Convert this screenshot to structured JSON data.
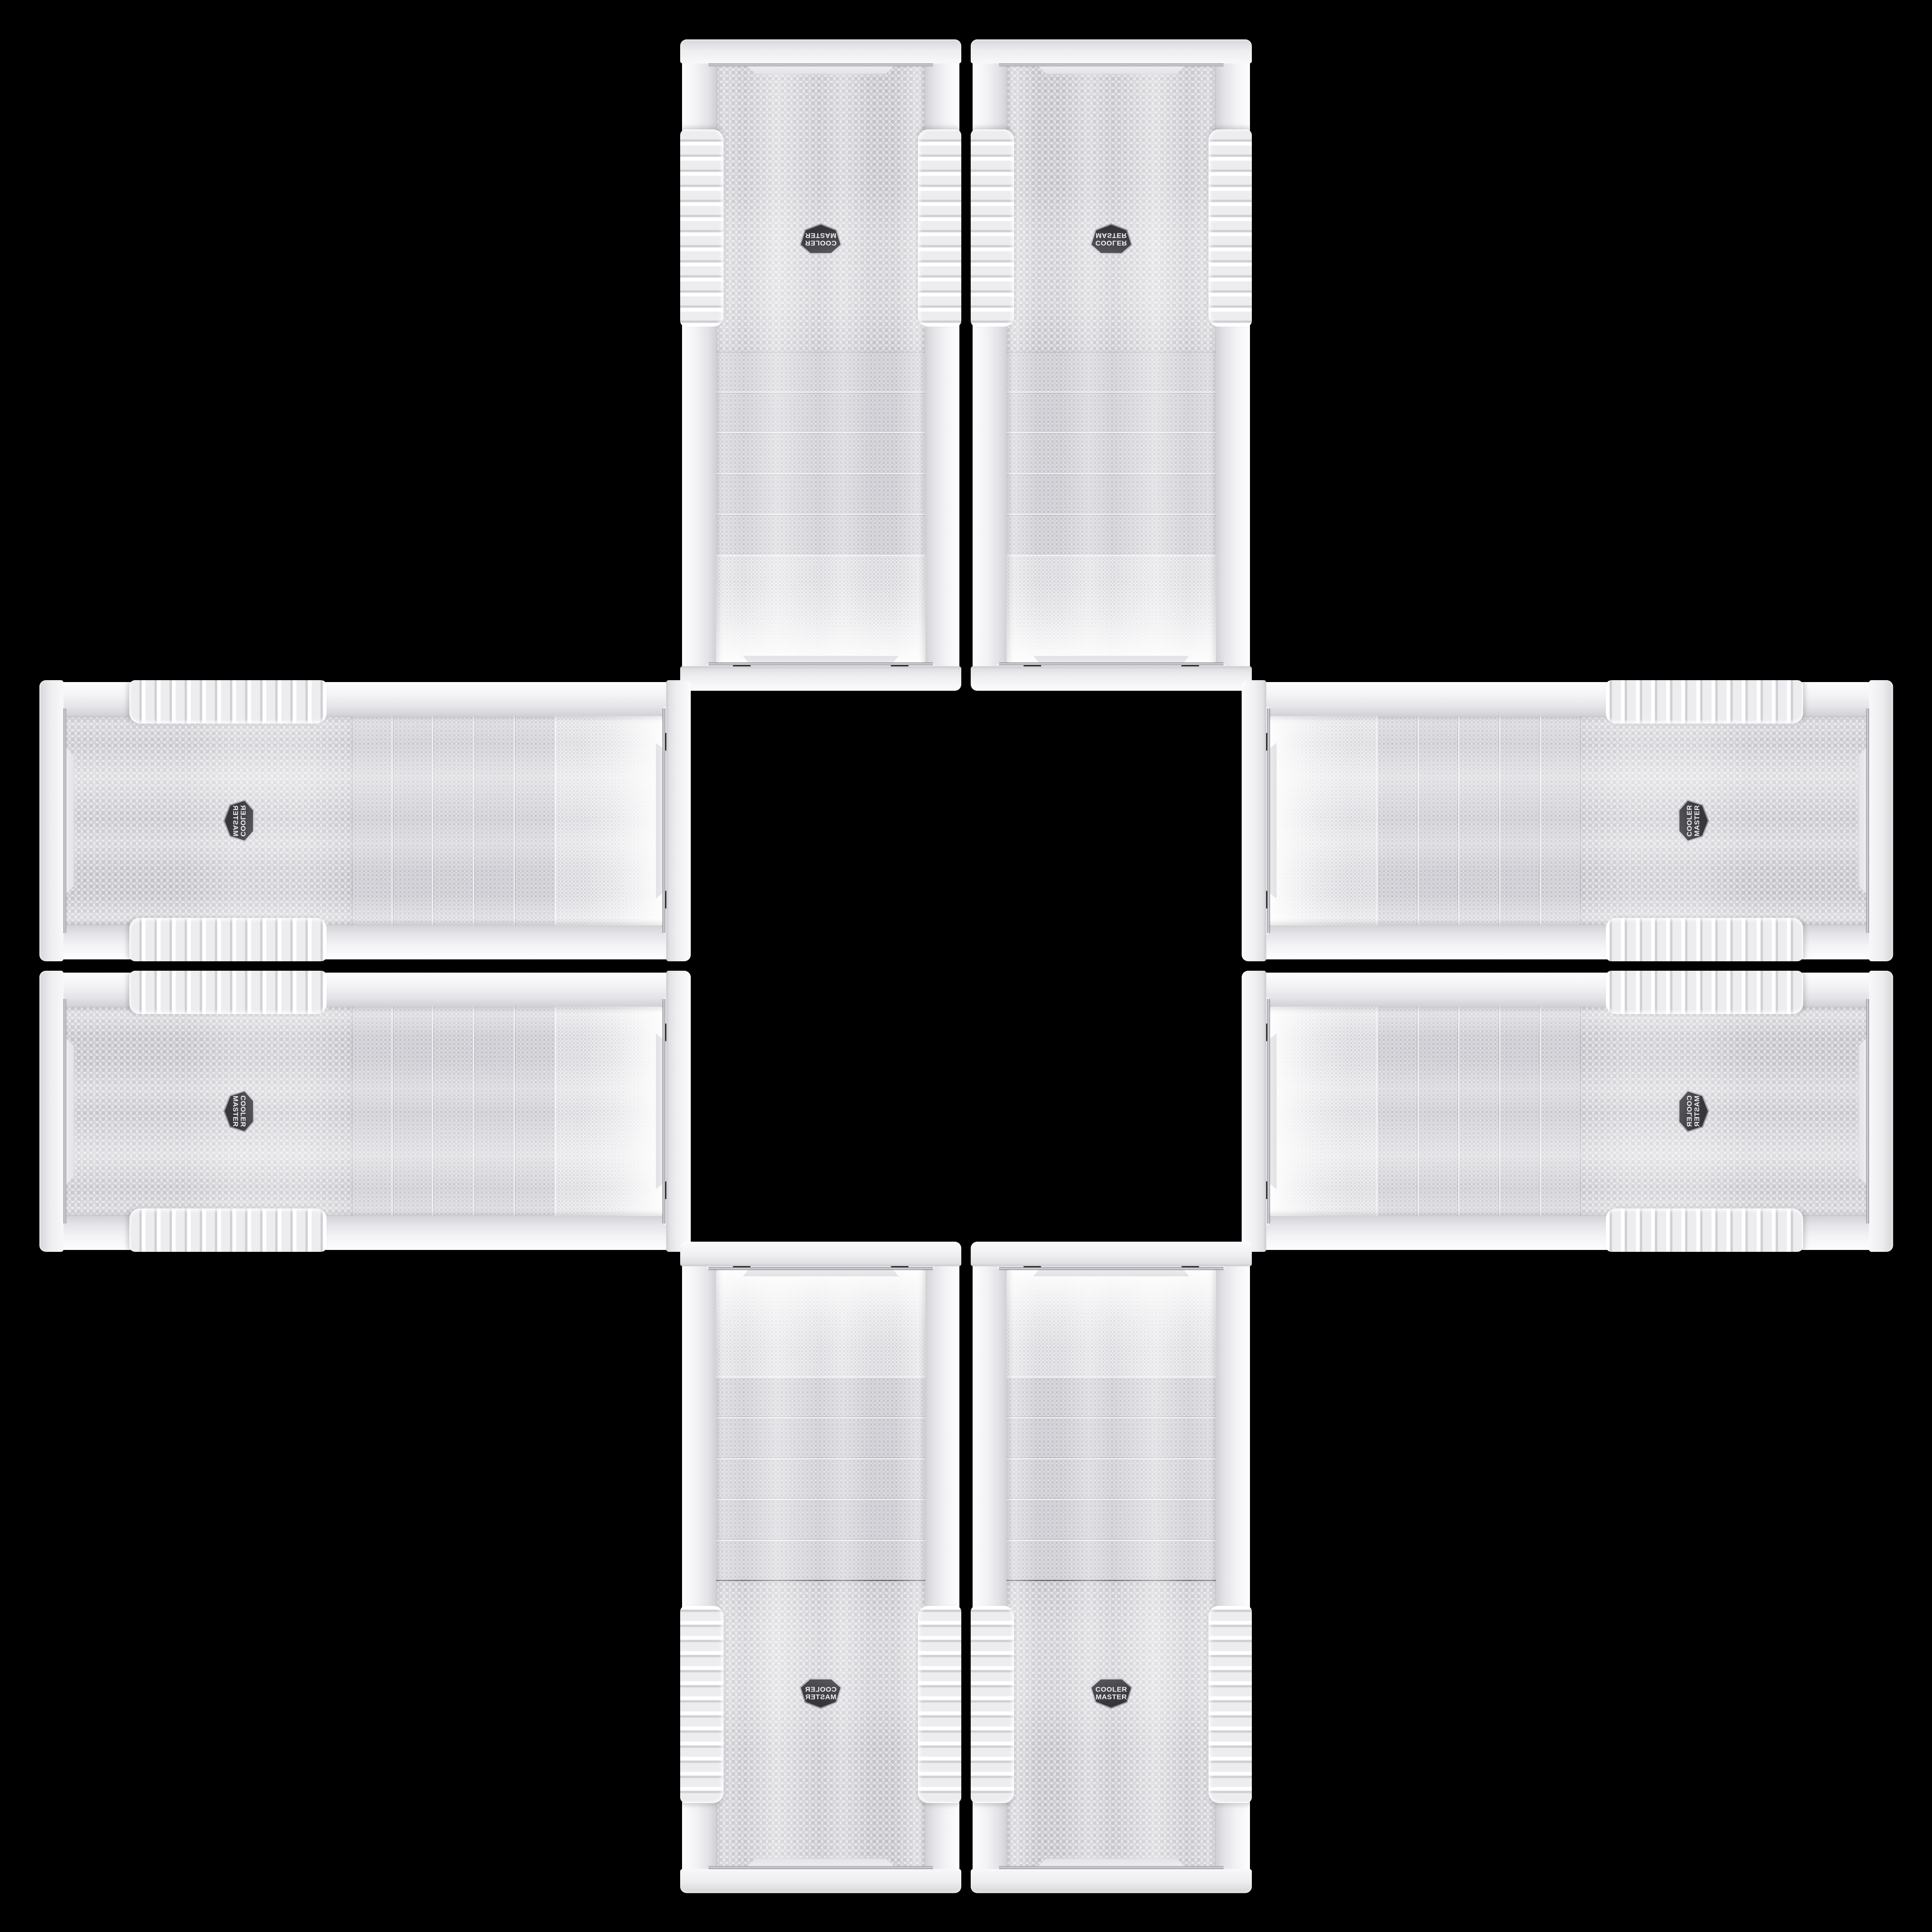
{
  "scene": {
    "description": "Eight identical white Cooler Master PC-case front bezels arranged in a mirror-symmetric plus/cross pattern on a black background",
    "brand": "Cooler Master",
    "background_color": "#000000",
    "panel_count": 8
  },
  "badge": {
    "line1": "COOLER",
    "line2": "MASTER",
    "badge_color": "#3a3a3f",
    "ring_color": "#a8a8ae",
    "text_color": "#f2f2f4"
  },
  "panel": {
    "base_color": "#ededf0",
    "rail_color": "#f3f3f6",
    "mesh_color": "#e8e8eb",
    "mesh_dot_color": "#c2c2c8",
    "trim_color": "#8e8e96",
    "drive_bay_count": 5,
    "grip_rib_count": 13
  },
  "layout": {
    "panels": [
      {
        "id": "top-left-vertical",
        "orientation": "vertical",
        "mirror": "rotated-180"
      },
      {
        "id": "top-right-vertical",
        "orientation": "vertical",
        "mirror": "flipped-vertical"
      },
      {
        "id": "left-top-horizontal",
        "orientation": "horizontal",
        "mirror": "rotated-90-flipped"
      },
      {
        "id": "left-bottom-horizontal",
        "orientation": "horizontal",
        "mirror": "rotated-90"
      },
      {
        "id": "right-top-horizontal",
        "orientation": "horizontal",
        "mirror": "rotated-270"
      },
      {
        "id": "right-bottom-horizontal",
        "orientation": "horizontal",
        "mirror": "rotated-90-mirrored"
      },
      {
        "id": "bottom-left-vertical",
        "orientation": "vertical",
        "mirror": "flipped-horizontal"
      },
      {
        "id": "bottom-right-vertical",
        "orientation": "vertical",
        "mirror": "none"
      }
    ]
  }
}
